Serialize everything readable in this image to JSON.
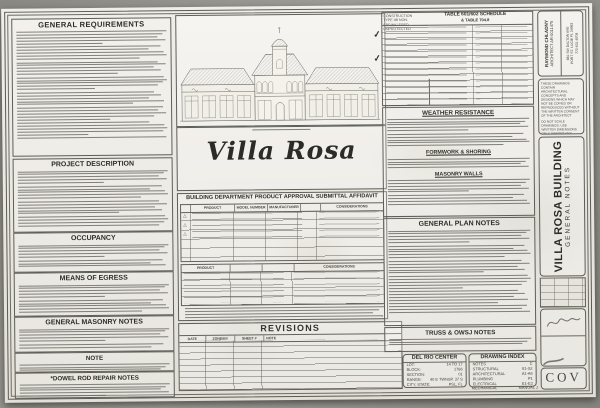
{
  "left": {
    "sections": [
      "GENERAL REQUIREMENTS",
      "PROJECT DESCRIPTION",
      "OCCUPANCY",
      "MEANS OF EGRESS",
      "GENERAL MASONRY NOTES",
      "NOTE",
      "*DOWEL ROD REPAIR NOTES"
    ]
  },
  "center": {
    "project_title": "Villa Rosa",
    "affidavit_title": "BUILDING DEPARTMENT PRODUCT APPROVAL SUBMITTAL AFFIDAVIT",
    "table1_headers": [
      "PRODUCT",
      "MODEL NUMBER",
      "MANUFACTURER",
      "",
      "CONSIDERATIONS"
    ],
    "table2_headers": [
      "PRODUCT",
      "",
      "",
      "CONSIDERATIONS"
    ],
    "revisions": {
      "title": "REVISIONS",
      "columns": [
        "DATE",
        "ZONE/BY",
        "SHEET #",
        "NOTE"
      ]
    }
  },
  "notes": {
    "schedule_title_line1": "TABLE 601/602 SCHEDULE",
    "schedule_title_line2": "& TABLE 704.8",
    "construction_type": "CONSTRUCTION TYPE IIB NON-SPRINKLERED UNPROTECTED",
    "sections": [
      "WEATHER RESISTANCE",
      "FORMWORK & SHORING",
      "MASONRY WALLS",
      "GENERAL PLAN NOTES",
      "TRUSS & OWSJ NOTES"
    ]
  },
  "site": {
    "title": "DEL RIO CENTER",
    "rows": [
      [
        "LOT:",
        "14 TO 17"
      ],
      [
        "BLOCK:",
        "1786"
      ],
      [
        "SECTION:",
        "01"
      ],
      [
        "RANGE:",
        "40 E TWNSP. 37 S"
      ],
      [
        "CITY, STATE:",
        "PSL, FL"
      ]
    ]
  },
  "drawing_index": {
    "title": "DRAWING INDEX",
    "rows": [
      [
        "NOTES",
        "C"
      ],
      [
        "STRUCTURAL",
        "S1-S2"
      ],
      [
        "ARCHITECTURAL",
        "A1-A6"
      ],
      [
        "PLUMBING",
        "P1"
      ],
      [
        "ELECTRICAL",
        "E1-E3"
      ]
    ],
    "overflow_row": [
      "MECHANICAL",
      "MANUAL J"
    ]
  },
  "titleblock": {
    "architect_name": "RAYMOND CHLADNY",
    "architect_license": "ARCHITECT AR-0011475",
    "address_line1": "881 SW DALTON AVE",
    "address_line2": "PORT ST. LUCIE FL 34983",
    "phone": "772-631-8708",
    "copyright_1": "THESE DRAWINGS CONTAIN ARCHITECTURAL CONCEPTS AND DESIGNS WHICH MAY NOT BE COPIED OR REPRODUCED WITHOUT THE WRITTEN CONSENT OF THE ARCHITECT",
    "copyright_2": "DO NOT SCALE DRAWINGS. USE WRITTEN DIMENSIONS ONLY. REPORT ANY DISCREPANCIES TO THE ARCHITECT",
    "sheet_title_line1": "VILLA ROSA BUILDING",
    "sheet_title_line2": "GENERAL NOTES",
    "sheet_number": "COV"
  },
  "colors": {
    "paper": "#ebe8e0",
    "ink": "#3a3833",
    "backdrop": "#8a8882"
  }
}
